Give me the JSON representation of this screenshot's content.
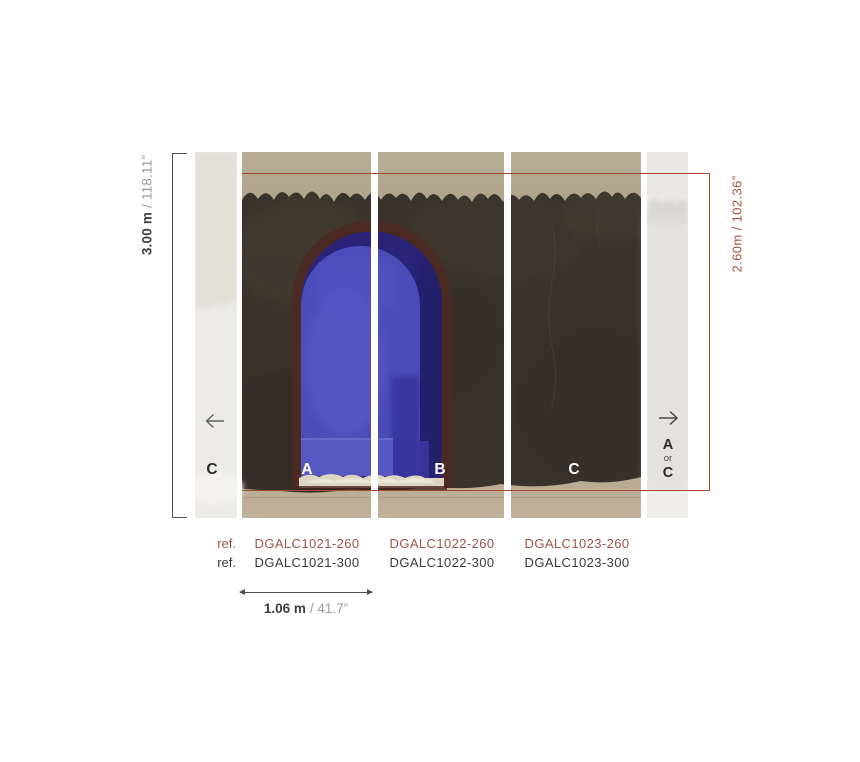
{
  "panels": {
    "letter_a": "A",
    "letter_b": "B",
    "letter_c": "C",
    "left_strip_letter": "C",
    "right_strip": {
      "line1": "A",
      "line2": "or",
      "line3": "C"
    }
  },
  "dimensions": {
    "full_height": {
      "metric": "3.00 m",
      "imperial": "/ 118.11”"
    },
    "crop_height": "2.60m / 102.36”",
    "panel_width": {
      "metric": "1.06 m",
      "imperial": "/ 41.7”"
    }
  },
  "references": {
    "label": "ref.",
    "row_260": [
      "DGALC1021-260",
      "DGALC1022-260",
      "DGALC1023-260"
    ],
    "row_300": [
      "DGALC1021-300",
      "DGALC1022-300",
      "DGALC1023-300"
    ]
  },
  "colors": {
    "crop_mark_red": "#9e4a31",
    "ref_260_red": "#9d5546",
    "ref_300_dark": "#3a3a3a",
    "dimension_dark": "#3d3d3d",
    "dimension_gray": "#9b9b9b",
    "wall_dark_brown": "#39332b",
    "plaster_tan": "#b2a78e",
    "arch_bright_blue": "#4b4cb8",
    "arch_dark_blue": "#2a2478",
    "arch_border_maroon": "#4b2a24",
    "strip_light_gray": "#eae8e3"
  }
}
